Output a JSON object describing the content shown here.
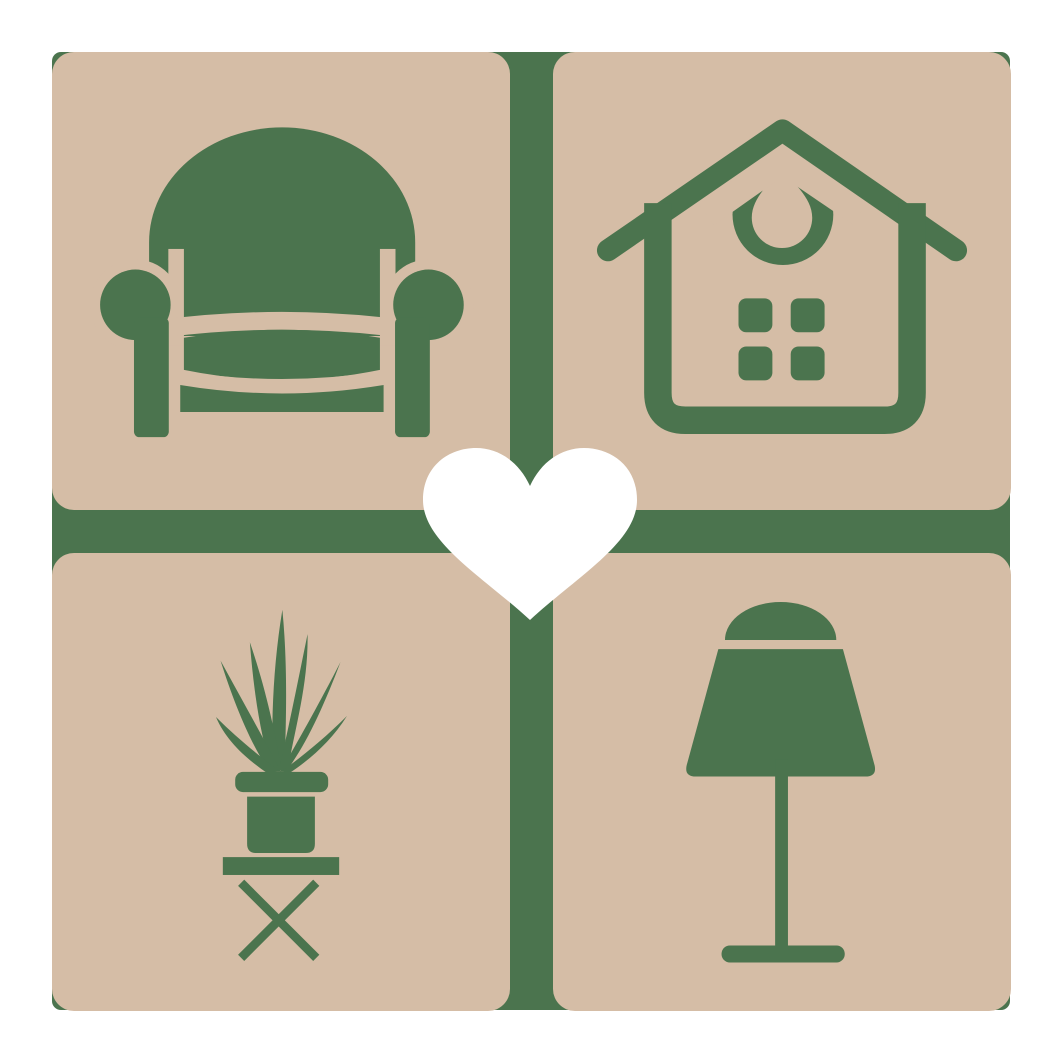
{
  "canvas": {
    "width": 1063,
    "height": 1063,
    "background": "#ffffff"
  },
  "colors": {
    "tile_tan": "#d5bda6",
    "icon_green": "#4b744e",
    "heart_white": "#ffffff",
    "page_background": "#ffffff"
  },
  "logo": {
    "backing": {
      "x": 52,
      "y": 52,
      "size": 958,
      "corner_radius": 9
    },
    "tile_size": 458,
    "tile_corner_radius": 22,
    "gap_between_tiles": 43,
    "tiles": [
      {
        "position": "top-left",
        "icon": "armchair-icon",
        "subject": "armchair"
      },
      {
        "position": "top-right",
        "icon": "house-icon",
        "subject": "house with drop ornament and four windows"
      },
      {
        "position": "bottom-left",
        "icon": "potted-plant-icon",
        "subject": "spiky potted plant on cross-legged stool"
      },
      {
        "position": "bottom-right",
        "icon": "table-lamp-icon",
        "subject": "table lamp"
      }
    ],
    "heart": {
      "x": 423,
      "y": 446,
      "width": 214,
      "height": 177
    }
  }
}
